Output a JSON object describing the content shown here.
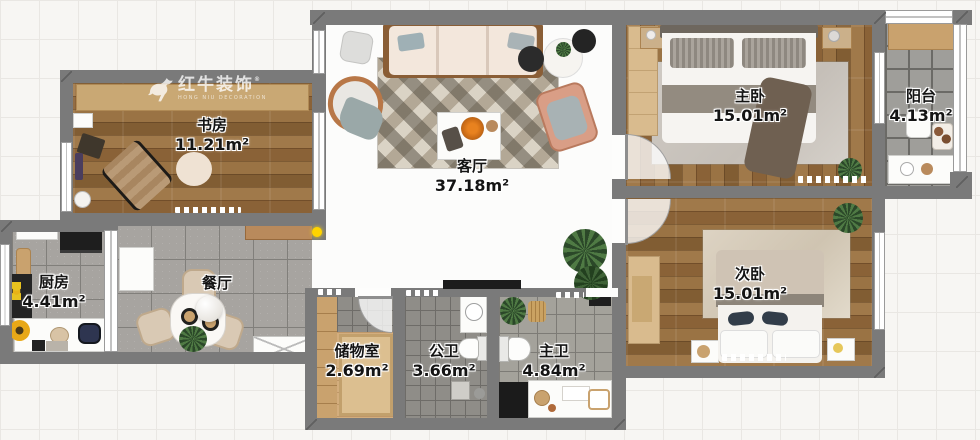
{
  "watermark": {
    "brand": "红牛装饰",
    "subtitle": "HONG NIU DECORATION",
    "reg": "®"
  },
  "rooms": [
    {
      "id": "study",
      "name": "书房",
      "area": "11.21m²"
    },
    {
      "id": "living",
      "name": "客厅",
      "area": "37.18m²"
    },
    {
      "id": "master-bedroom",
      "name": "主卧",
      "area": "15.01m²"
    },
    {
      "id": "balcony",
      "name": "阳台",
      "area": "4.13m²"
    },
    {
      "id": "second-bedroom",
      "name": "次卧",
      "area": "15.01m²"
    },
    {
      "id": "kitchen",
      "name": "厨房",
      "area": "4.41m²"
    },
    {
      "id": "dining",
      "name": "餐厅",
      "area": ""
    },
    {
      "id": "storage",
      "name": "储物室",
      "area": "2.69m²"
    },
    {
      "id": "public-bath",
      "name": "公卫",
      "area": "3.66m²"
    },
    {
      "id": "master-bath",
      "name": "主卫",
      "area": "4.84m²"
    }
  ],
  "colors": {
    "wall": "#7a7a7a",
    "wood_floor": "#96713f",
    "tile_floor": "#a7a4a0",
    "living_floor": "#fcfcfb",
    "background_grid": "#f7f6f3",
    "door_dot_accent": "#ffd400"
  }
}
